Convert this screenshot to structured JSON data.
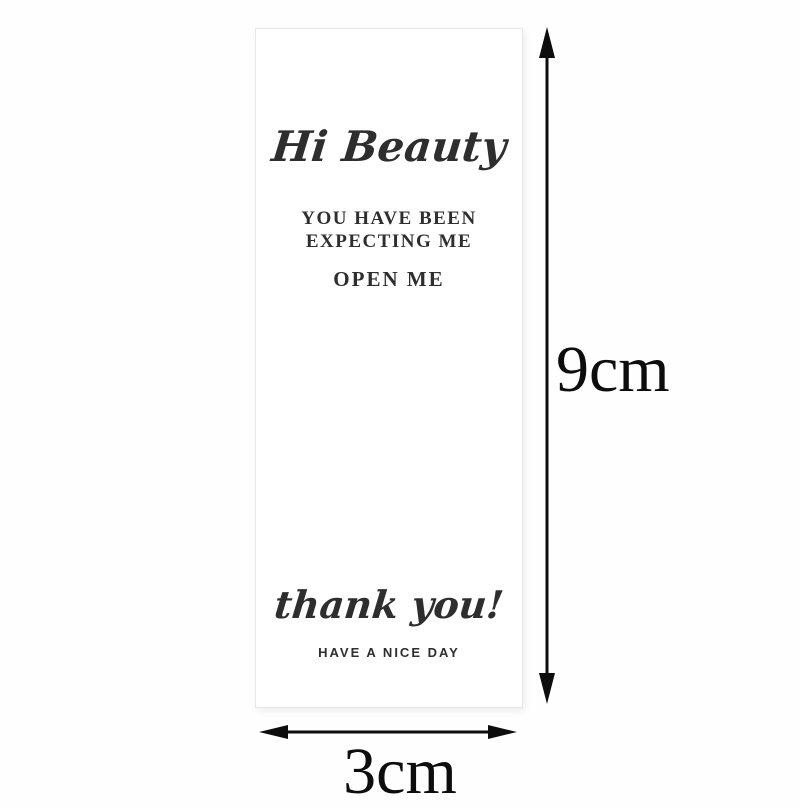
{
  "card": {
    "greeting": "Hi Beauty",
    "message_line1": "YOU HAVE BEEN",
    "message_line2": "EXPECTING ME",
    "open_line": "OPEN ME",
    "thanks": "thank you!",
    "footer": "HAVE A NICE DAY"
  },
  "dimensions": {
    "height": "9cm",
    "width": "3cm"
  },
  "colors": {
    "page_bg": "#fefefe",
    "card_bg": "#ffffff",
    "card_border": "#e8e8e8",
    "card_text": "#2b2b2b",
    "footer_text": "#4f4f4f",
    "arrow": "#0d0d0d"
  }
}
